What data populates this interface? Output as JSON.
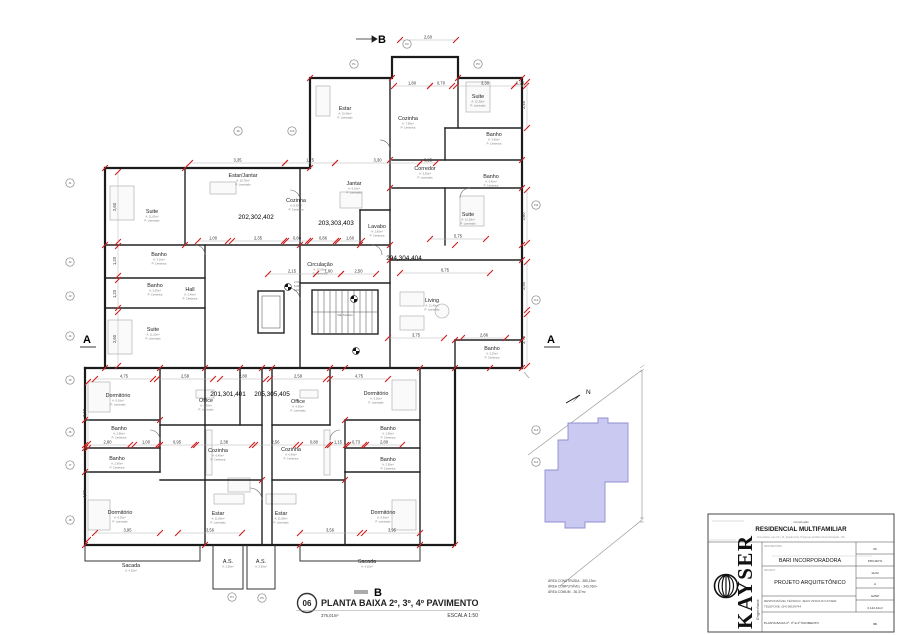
{
  "markers": {
    "section_a": "A",
    "section_b": "B"
  },
  "site": {
    "north": "N",
    "areas": [
      "ÁREA CONSTRUÍDA - 380,13m²",
      "ÁREA COMPUTÁVEL - 343,76m²",
      "ÁREA COMUM - 36,37m²"
    ]
  },
  "footer": {
    "num": "06",
    "title": "PLANTA BAIXA 2º, 3º, 4º PAVIMENTO",
    "area": "376,01m²",
    "scale": "ESCALA 1:50"
  },
  "title_block": {
    "construction_label": "Construção",
    "project_name": "RESIDENCIAL MULTIFAMILIAR",
    "address": "Rua Caxias, Lote 15 e 16, Quadra 12 E, Progresso do Bairro Novo Petrópolis - RS",
    "owner": "BARI INCORPORADORA",
    "owner_label": "PROPRIETÁRIO",
    "project_label": "PROJETO",
    "project_type": "PROJETO ARQUITETÔNICO",
    "responsible": "RESPONSÁVEL TÉCNICO: JEAN VINICIUS KAYSER",
    "phone": "TELEFONE: (54) 98199744",
    "sheet_title": "PLANTA BAIXA 2º, 3º E 4º PAVIMENTO",
    "logo_text": "KAYSER",
    "logo_sub": "Engenharia",
    "fields": [
      "06",
      "PROJETO",
      "11/22",
      "A",
      "GZNP",
      "3.142,44m²",
      "06"
    ]
  },
  "plan": {
    "levels": [
      "2,72",
      "5,44",
      "8,16"
    ],
    "shaft_label": "Vão Técnico",
    "rooms": [
      {
        "l": "Suite",
        "x": 152,
        "y": 213,
        "a": "A: 11,63m²",
        "p": "P: Laminado"
      },
      {
        "l": "Banho",
        "x": 159,
        "y": 256,
        "a": "A: 3,10m²",
        "p": "P: Cerâmica"
      },
      {
        "l": "Banho",
        "x": 155,
        "y": 287,
        "a": "A: 3,05m²",
        "p": "P: Cerâmica"
      },
      {
        "l": "Hall",
        "x": 190,
        "y": 291,
        "a": "A: 2,40m²",
        "p": "P: Cerâmica"
      },
      {
        "l": "Suite",
        "x": 153,
        "y": 331,
        "a": "A: 11,20m²",
        "p": "P: Laminado"
      },
      {
        "l": "Estar/Jantar",
        "x": 243,
        "y": 177,
        "a": "A: 18,75m²",
        "p": "P: Laminado"
      },
      {
        "l": "Cozinha",
        "x": 296,
        "y": 202,
        "a": "A: 8,30m²",
        "p": "P: Cerâmica"
      },
      {
        "l": "Estar",
        "x": 345,
        "y": 110,
        "a": "A: 15,40m²",
        "p": "P: Laminado"
      },
      {
        "l": "Cozinha",
        "x": 408,
        "y": 120,
        "a": "A: 7,95m²",
        "p": "P: Cerâmica"
      },
      {
        "l": "Jantar",
        "x": 354,
        "y": 185,
        "a": "A: 9,10m²",
        "p": "P: Laminado"
      },
      {
        "l": "Corredor",
        "x": 425,
        "y": 170,
        "a": "A: 3,20m²",
        "p": "P: Laminado"
      },
      {
        "l": "Suite",
        "x": 478,
        "y": 98,
        "a": "A: 12,30m²",
        "p": "P: Laminado"
      },
      {
        "l": "Banho",
        "x": 494,
        "y": 136,
        "a": "A: 3,60m²",
        "p": "P: Cerâmica"
      },
      {
        "l": "Banho",
        "x": 491,
        "y": 178,
        "a": "A: 3,40m²",
        "p": "P: Cerâmica"
      },
      {
        "l": "Suite",
        "x": 468,
        "y": 216,
        "a": "A: 13,10m²",
        "p": "P: Laminado"
      },
      {
        "l": "Lavabo",
        "x": 377,
        "y": 228,
        "a": "A: 1,60m²",
        "p": "P: Cerâmica"
      },
      {
        "l": "Circulação",
        "x": 320,
        "y": 266,
        "a": "A: 12,06m²",
        "p": "P: Cerâmica"
      },
      {
        "l": "Living",
        "x": 432,
        "y": 302,
        "a": "A: 21,40m²",
        "p": "P: Laminado"
      },
      {
        "l": "Banho",
        "x": 492,
        "y": 350,
        "a": "A: 3,20m²",
        "p": "P: Cerâmica"
      },
      {
        "l": "Dormitório",
        "x": 118,
        "y": 397,
        "a": "A: 9,16m²",
        "p": "P: Laminado"
      },
      {
        "l": "Office",
        "x": 206,
        "y": 402,
        "a": "A: 4,30m²",
        "p": "P: Laminado"
      },
      {
        "l": "Banho",
        "x": 119,
        "y": 430,
        "a": "A: 2,96m²",
        "p": "P: Cerâmica"
      },
      {
        "l": "Banho",
        "x": 117,
        "y": 460,
        "a": "A: 2,90m²",
        "p": "P: Cerâmica"
      },
      {
        "l": "Cozinha",
        "x": 218,
        "y": 452,
        "a": "A: 6,40m²",
        "p": "P: Cerâmica"
      },
      {
        "l": "Dormitório",
        "x": 120,
        "y": 514,
        "a": "A: 9,30m²",
        "p": "P: Laminado"
      },
      {
        "l": "Estar",
        "x": 218,
        "y": 515,
        "a": "A: 11,80m²",
        "p": "P: Laminado"
      },
      {
        "l": "Office",
        "x": 298,
        "y": 403,
        "a": "A: 4,30m²",
        "p": "P: Laminado"
      },
      {
        "l": "Dormitório",
        "x": 376,
        "y": 395,
        "a": "A: 9,16m²",
        "p": "P: Laminado"
      },
      {
        "l": "Banho",
        "x": 388,
        "y": 430,
        "a": "A: 2,96m²",
        "p": "P: Cerâmica"
      },
      {
        "l": "Banho",
        "x": 388,
        "y": 461,
        "a": "A: 2,90m²",
        "p": "P: Cerâmica"
      },
      {
        "l": "Cozinha",
        "x": 291,
        "y": 451,
        "a": "A: 6,40m²",
        "p": "P: Cerâmica"
      },
      {
        "l": "Estar",
        "x": 281,
        "y": 515,
        "a": "A: 11,80m²",
        "p": "P: Laminado"
      },
      {
        "l": "Dormitório",
        "x": 383,
        "y": 514,
        "a": "A: 9,30m²",
        "p": "P: Laminado"
      },
      {
        "l": "Sacada",
        "x": 131,
        "y": 567,
        "a": "A: 4,10m²"
      },
      {
        "l": "A.S.",
        "x": 228,
        "y": 563,
        "a": "A: 2,56m²"
      },
      {
        "l": "A.S.",
        "x": 261,
        "y": 563,
        "a": "A: 2,56m²"
      },
      {
        "l": "Sacada",
        "x": 367,
        "y": 563,
        "a": "A: 4,10m²"
      },
      {
        "l": "Vão Técnico",
        "x": 345,
        "y": 316,
        "s": true
      }
    ],
    "units": [
      {
        "l": "202,302,402",
        "x": 256,
        "y": 219
      },
      {
        "l": "203,303,403",
        "x": 336,
        "y": 225
      },
      {
        "l": "204,304,404",
        "x": 404,
        "y": 260
      },
      {
        "l": "201,301,401",
        "x": 228,
        "y": 396
      },
      {
        "l": "205,305,405",
        "x": 272,
        "y": 396
      }
    ],
    "dims": [
      [
        "h",
        "2,60",
        400,
        456,
        40
      ],
      [
        "h",
        "1,80",
        394,
        430,
        86
      ],
      [
        "h",
        "0,70",
        430,
        452,
        86
      ],
      [
        "h",
        "3,30",
        456,
        514,
        86
      ],
      [
        "h",
        "0,20",
        514,
        526,
        86
      ],
      [
        "h",
        "3,35",
        190,
        285,
        163
      ],
      [
        "h",
        "1,75",
        285,
        335,
        163
      ],
      [
        "h",
        "3,30",
        335,
        420,
        163
      ],
      [
        "h",
        "0,25",
        420,
        436,
        163
      ],
      [
        "h",
        "5,75",
        430,
        486,
        239
      ],
      [
        "h",
        "1,00",
        198,
        228,
        241
      ],
      [
        "h",
        "2,35",
        232,
        284,
        241
      ],
      [
        "h",
        "0,88",
        286,
        308,
        241
      ],
      [
        "h",
        "0,86",
        310,
        336,
        241
      ],
      [
        "h",
        "1,60",
        338,
        362,
        241
      ],
      [
        "h",
        "2,15",
        268,
        316,
        274
      ],
      [
        "h",
        "1,00",
        316,
        341,
        274
      ],
      [
        "h",
        "2,50",
        341,
        376,
        274
      ],
      [
        "h",
        "6,75",
        400,
        490,
        273
      ],
      [
        "h",
        "3,75",
        388,
        444,
        338
      ],
      [
        "h",
        "2,86",
        462,
        506,
        338
      ],
      [
        "h",
        "4,75",
        95,
        153,
        379
      ],
      [
        "h",
        "2,58",
        157,
        213,
        379
      ],
      [
        "h",
        "2,80",
        220,
        266,
        379
      ],
      [
        "h",
        "2,58",
        270,
        326,
        379
      ],
      [
        "h",
        "4,75",
        330,
        388,
        379
      ],
      [
        "h",
        "2,80",
        85,
        130,
        445
      ],
      [
        "h",
        "1,00",
        134,
        158,
        445
      ],
      [
        "h",
        "0,95",
        160,
        194,
        445
      ],
      [
        "h",
        "2,38",
        196,
        252,
        445
      ],
      [
        "h",
        "2,56",
        255,
        296,
        445
      ],
      [
        "h",
        "0,80",
        300,
        328,
        445
      ],
      [
        "h",
        "1,15",
        330,
        346,
        445
      ],
      [
        "h",
        "0,73",
        348,
        364,
        445
      ],
      [
        "h",
        "2,80",
        366,
        402,
        445
      ],
      [
        "h",
        "3,95",
        95,
        160,
        533
      ],
      [
        "h",
        "3,56",
        178,
        242,
        533
      ],
      [
        "h",
        "3,56",
        300,
        360,
        533
      ],
      [
        "h",
        "3,95",
        364,
        420,
        533
      ],
      [
        "v",
        "2,60",
        172,
        242,
        118
      ],
      [
        "v",
        "1,20",
        246,
        276,
        118
      ],
      [
        "v",
        "1,20",
        280,
        308,
        118
      ],
      [
        "v",
        "2,60",
        312,
        366,
        118
      ],
      [
        "v",
        "2,40",
        82,
        128,
        527
      ],
      [
        "v",
        "3,60",
        190,
        243,
        527
      ],
      [
        "v",
        "2,50",
        262,
        310,
        527
      ],
      [
        "v",
        "3,75",
        314,
        366,
        527
      ],
      [
        "v",
        "3,10",
        382,
        444,
        88
      ],
      [
        "v",
        "4,86",
        448,
        540,
        88
      ]
    ],
    "bubbles": [
      [
        70,
        183,
        "J1"
      ],
      [
        70,
        262,
        "J2"
      ],
      [
        70,
        296,
        "J3"
      ],
      [
        70,
        336,
        "J4"
      ],
      [
        70,
        380,
        "J5"
      ],
      [
        70,
        432,
        "J6"
      ],
      [
        70,
        465,
        "J7"
      ],
      [
        70,
        520,
        "J8"
      ],
      [
        354,
        64,
        "P1"
      ],
      [
        407,
        44,
        "P2"
      ],
      [
        478,
        64,
        "P3"
      ],
      [
        238,
        131,
        "J9"
      ],
      [
        292,
        131,
        "J10"
      ],
      [
        536,
        205,
        "J11"
      ],
      [
        536,
        300,
        "J12"
      ],
      [
        536,
        430,
        "J13"
      ],
      [
        536,
        462,
        "J14"
      ],
      [
        232,
        597,
        "P4"
      ],
      [
        262,
        598,
        "P5"
      ]
    ],
    "ticks": [
      [
        105,
        368
      ],
      [
        160,
        368
      ],
      [
        205,
        368
      ],
      [
        240,
        368
      ],
      [
        262,
        368
      ],
      [
        272,
        368
      ],
      [
        330,
        368
      ],
      [
        345,
        368
      ],
      [
        420,
        368
      ],
      [
        455,
        368
      ],
      [
        490,
        368
      ],
      [
        522,
        368
      ],
      [
        105,
        245
      ],
      [
        185,
        245
      ],
      [
        300,
        245
      ],
      [
        360,
        245
      ],
      [
        390,
        245
      ],
      [
        455,
        245
      ],
      [
        522,
        245
      ],
      [
        85,
        420
      ],
      [
        85,
        448
      ],
      [
        85,
        472
      ],
      [
        85,
        545
      ],
      [
        205,
        545
      ],
      [
        300,
        545
      ],
      [
        420,
        545
      ],
      [
        455,
        545
      ],
      [
        310,
        78
      ],
      [
        392,
        78
      ],
      [
        458,
        78
      ],
      [
        522,
        78
      ],
      [
        390,
        160
      ],
      [
        522,
        160
      ],
      [
        390,
        188
      ],
      [
        522,
        188
      ],
      [
        390,
        260
      ],
      [
        522,
        260
      ],
      [
        455,
        340
      ],
      [
        522,
        340
      ],
      [
        105,
        168
      ],
      [
        185,
        168
      ],
      [
        310,
        168
      ],
      [
        160,
        420
      ],
      [
        345,
        420
      ],
      [
        262,
        480
      ],
      [
        345,
        480
      ]
    ]
  }
}
